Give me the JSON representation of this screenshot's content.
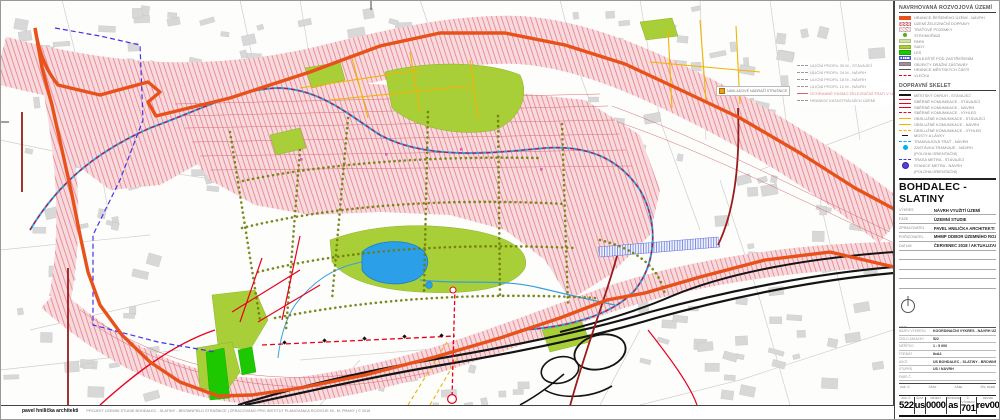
{
  "colors": {
    "boundary_orange": "#e8521a",
    "rail_pink": "#f7dade",
    "rail_hatch_red": "#e25560",
    "park_green": "#a9cf38",
    "forest_green": "#1ec800",
    "water_blue": "#2b9fe8",
    "road_red": "#e8001e",
    "road_dark_red": "#9b1b1b",
    "road_yellow": "#f2b300",
    "tram_cyan": "#00b0f0",
    "metro_violet": "#4433ee",
    "motorway_black": "#141414"
  },
  "legend_panel": {
    "section1": {
      "title": "NAVRHOVANÁ ROZVOJOVÁ ÚZEMÍ",
      "items": [
        {
          "label": "HRANICE ŘEŠENÉHO ÚZEMÍ - NÁVRH"
        },
        {
          "label": "ÚZEMÍ ŽELEZNIČNÍ DOPRAVY"
        },
        {
          "label": "TRAŤOVÉ POZEMKY"
        },
        {
          "label": "STROMOŘADÍ"
        },
        {
          "label": "PARK"
        },
        {
          "label": "SADY"
        },
        {
          "label": "LES"
        },
        {
          "label": "KOLEJIŠTĚ POD ZASTŘEŠENÍM"
        },
        {
          "label": "OBJEKTY DRÁŽNÍ ZÁSTAVBY"
        },
        {
          "label": "HRANICE MĚSTSKÝCH ČÁSTÍ"
        },
        {
          "label": "VLEČKA"
        }
      ]
    },
    "section2": {
      "title": "DOPRAVNÍ SKELET",
      "items": [
        {
          "label": "MĚSTSKÝ OKRUH - STÁVAJÍCÍ"
        },
        {
          "label": "SBĚRNÉ KOMUNIKACE - STÁVAJÍCÍ"
        },
        {
          "label": "SBĚRNÉ KOMUNIKACE - NÁVRH"
        },
        {
          "label": "SBĚRNÉ KOMUNIKACE - VÝHLED"
        },
        {
          "label": "OBSLUŽNÉ KOMUNIKACE - STÁVAJÍCÍ"
        },
        {
          "label": "OBSLUŽNÉ KOMUNIKACE - NÁVRH"
        },
        {
          "label": "OBSLUŽNÉ KOMUNIKACE - VÝHLED"
        },
        {
          "label": "MOSTY A LÁVKY"
        },
        {
          "label": "TRAMVAJOVÁ TRAŤ - NÁVRH"
        },
        {
          "label": "ZASTÁVKA TRAMVAJE - NÁVRH",
          "sub": "(POLOHA ORIENTAČNÍ)"
        },
        {
          "label": "TRASA METRA - STÁVAJÍCÍ"
        },
        {
          "label": "STANICE METRA - NÁVRH",
          "sub": "(POLOHA ORIENTAČNÍ)"
        }
      ]
    },
    "title_block": {
      "title": "BOHDALEC - SLATINY",
      "rows": [
        {
          "label": "VÝKRES",
          "value": "NÁVRH VYUŽITÍ ÚZEMÍ"
        },
        {
          "label": "FÁZE",
          "value": "ÚZEMNÍ STUDIE"
        },
        {
          "label": "ZPRACOVATEL",
          "value": "PAVEL HNILIČKA ARCHITEKTI"
        },
        {
          "label": "POŘIZOVATEL",
          "value": "MHMP ODBOR ÚZEMNÍHO ROZVOJE"
        },
        {
          "label": "DATUM",
          "value": "ČERVENEC 2018 / AKTUALIZACE"
        }
      ]
    },
    "north_label": "sever",
    "info_rows": [
      {
        "label": "NÁZEV VÝKRESU",
        "value": "KOORDINAČNÍ VÝKRES - NÁVRH ÚZEMÍ"
      },
      {
        "label": "ČÍSLO ZAKÁZKY",
        "value": "522"
      },
      {
        "label": "MĚŘÍTKO",
        "value": "1 : 5 000"
      },
      {
        "label": "FORMÁT",
        "value": "8xA4"
      },
      {
        "label": "AKCE",
        "value": "ÚS BOHDALEC - SLATINY - BROWNFIELD STRAŠNICE"
      },
      {
        "label": "STUPEŇ",
        "value": "US / NÁVRH"
      },
      {
        "label": "PARÉ Č.",
        "value": ""
      }
    ],
    "columns_header": [
      "ZAK. Č.",
      "ČÁST",
      "FÁZE",
      "ČÍS. PARÉ"
    ],
    "number_strip": [
      {
        "label": "ZAK. Č.",
        "value": "522"
      },
      {
        "label": "ČÁST",
        "value": "us"
      },
      {
        "label": "OBJEKT",
        "value": "0000"
      },
      {
        "label": "PROFESE",
        "value": "as"
      },
      {
        "label": "Č. VÝKRESU",
        "value": "701"
      },
      {
        "label": "REVIZE",
        "value": "rev00"
      }
    ]
  },
  "map": {
    "street_legend": {
      "items": [
        {
          "label": "ULIČNÍ PROFIL 30 M - STÁVAJÍCÍ"
        },
        {
          "label": "ULIČNÍ PROFIL 24 M - NÁVRH"
        },
        {
          "label": "ULIČNÍ PROFIL 18 M - NÁVRH"
        },
        {
          "label": "ULIČNÍ PROFIL 12 M - NÁVRH"
        },
        {
          "label": "OCHRANNÉ PÁSMO ŽELEZNIČNÍ TRATI V ÚZEMÍ"
        },
        {
          "label": "HRANICE KATASTRÁLNÍCH ÚZEMÍ"
        }
      ]
    },
    "callout": "NÁKLADOVÉ NÁDRAŽÍ STRAŠNICE"
  },
  "footer": {
    "firm": "pavel hnilička architekti",
    "note": "PROJEKT ÚZEMNÍ STUDIE BOHDALEC - SLATINY - BROWNFIELD STRAŠNICE  |  ZPRACOVÁNO PRO INSTITUT PLÁNOVÁNÍ A ROZVOJE HL. M. PRAHY  |  © 2018"
  }
}
